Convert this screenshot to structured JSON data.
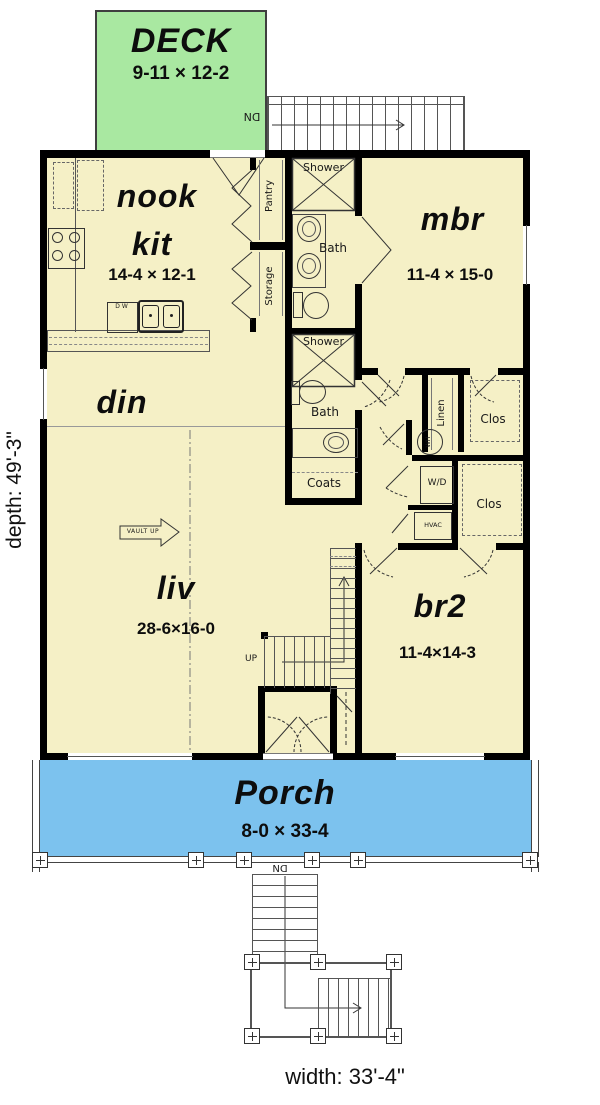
{
  "overall": {
    "depth_label": "depth: 49'-3\"",
    "width_label": "width: 33'-4\""
  },
  "colors": {
    "deck": "#a9e8a1",
    "floor": "#f5f0c6",
    "porch": "#7cc2ee",
    "wall": "#000000"
  },
  "deck": {
    "name": "DECK",
    "size": "9-11 × 12-2",
    "stair_down_label": "DN"
  },
  "kitchen": {
    "nook_label": "nook",
    "kit_label": "kit",
    "size": "14-4 × 12-1",
    "dishwasher_label": "DW"
  },
  "closets": {
    "pantry": "Pantry",
    "storage": "Storage",
    "linen": "Linen",
    "coats": "Coats",
    "clos_upper": "Clos",
    "clos_lower": "Clos"
  },
  "bath1": {
    "shower_label": "Shower",
    "name": "Bath"
  },
  "bath2": {
    "shower_label": "Shower",
    "name": "Bath"
  },
  "mbr": {
    "name": "mbr",
    "size": "11-4 × 15-0"
  },
  "din": {
    "name": "din"
  },
  "liv": {
    "name": "liv",
    "size": "28-6×16-0",
    "vault_label": "VAULT UP"
  },
  "br2": {
    "name": "br2",
    "size": "11-4×14-3"
  },
  "utility": {
    "water_heater_label": "WH",
    "washer_dryer_label": "W/D",
    "hvac_label": "HVAC"
  },
  "stairs": {
    "up_label": "UP",
    "porch_down_label": "DN"
  },
  "porch": {
    "name": "Porch",
    "size": "8-0 × 33-4"
  }
}
